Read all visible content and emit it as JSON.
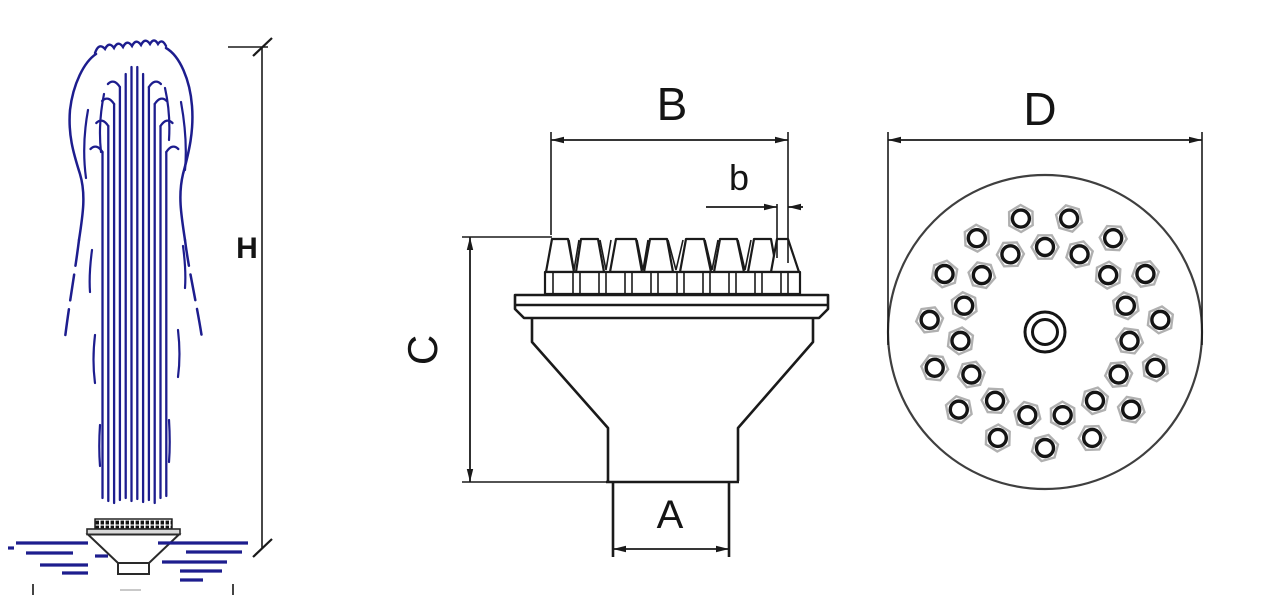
{
  "colors": {
    "water_blue": "#1d1d8e",
    "line_dark": "#1a1a1a",
    "nut_gray": "#b0b0b0",
    "circle_gray": "#3f3f3f"
  },
  "left_view": {
    "height_label": "H"
  },
  "side_view": {
    "top_width_label": "B",
    "tip_width_label": "b",
    "height_label": "C",
    "inlet_width_label": "A"
  },
  "top_view": {
    "diameter_label": "D",
    "center_x": 1045,
    "center_y": 332,
    "outer_radius": 157,
    "rings": [
      {
        "count": 15,
        "radius": 85,
        "start_angle_deg": -90
      },
      {
        "count": 15,
        "radius": 116,
        "start_angle_deg": -102
      }
    ],
    "hole_radius": 8.5,
    "nut_radius": 13.5,
    "center_hole_radii": [
      20,
      12.5
    ]
  }
}
